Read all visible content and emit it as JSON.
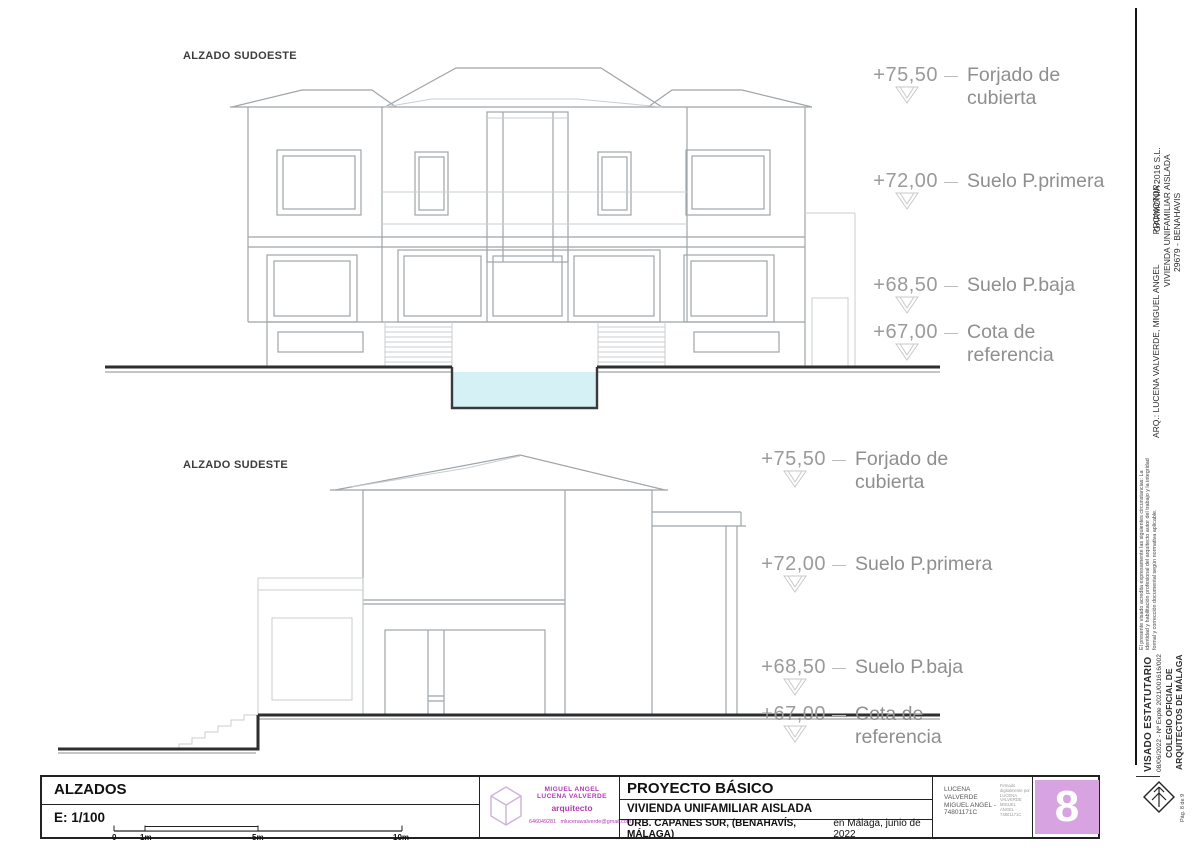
{
  "elevations": [
    {
      "label": "ALZADO SUDOESTE",
      "markers": [
        {
          "value": "+75,50",
          "label1": "Forjado de",
          "label2": "cubierta"
        },
        {
          "value": "+72,00",
          "label1": "Suelo P.primera",
          "label2": ""
        },
        {
          "value": "+68,50",
          "label1": "Suelo P.baja",
          "label2": ""
        },
        {
          "value": "+67,00",
          "label1": "Cota de",
          "label2": "referencia"
        }
      ]
    },
    {
      "label": "ALZADO SUDESTE",
      "markers": [
        {
          "value": "+75,50",
          "label1": "Forjado de",
          "label2": "cubierta"
        },
        {
          "value": "+72,00",
          "label1": "Suelo P.primera",
          "label2": ""
        },
        {
          "value": "+68,50",
          "label1": "Suelo P.baja",
          "label2": ""
        },
        {
          "value": "+67,00",
          "label1": "Cota de",
          "label2": "referencia"
        }
      ]
    }
  ],
  "titleblock": {
    "drawing_title": "ALZADOS",
    "scale_label": "E: 1/100",
    "scale_ticks": [
      "0",
      "1m",
      "5m",
      "10m"
    ],
    "architect": {
      "name": "MIGUEL ANGEL LUCENA VALVERDE",
      "role": "arquitecto",
      "phone": "646049281",
      "email": "mlucenavalverde@gmail.com"
    },
    "project": {
      "type": "PROYECTO BÁSICO",
      "name": "VIVIENDA UNIFAMILIAR AISLADA",
      "address": "URB. CAPANES SUR, (BENAHAVÍS, MÁLAGA)",
      "date": "en Málaga, junio de 2022"
    },
    "signature": {
      "name": "LUCENA VALVERDE MIGUEL ANGEL - 74801171C",
      "detail": "Firmado digitalmente por LUCENA VALVERDE MIGUEL ANGEL - 74801171C"
    },
    "sheet_number": "8"
  },
  "sidebar": {
    "arq_line": "ARQ.: LUCENA VALVERDE, MIGUEL ANGEL",
    "promotor_label": "PROMOTOR:",
    "promotor": "GARMONIA 2016 S.L.",
    "project": "VIVIENDA UNIFAMILIAR AISLADA",
    "location": "29679 - BENAHAVIS",
    "visado_note": "El presente visado acredita expresamente las siguientes circunstancias: La identidad y habilitación profesional del arquitecto autor del trabajo y la integridad formal y corrección documental según normativa aplicable.",
    "visado_title": "VISADO ESTATUTARIO",
    "visado_ref": "08/06/2022 - Nº Expte 2021/001616/002",
    "colegio_line1": "COLEGIO OFICIAL DE",
    "colegio_line2": "ARQUITECTOS DE MÁLAGA",
    "page": "Pág. 8 de 9"
  },
  "colors": {
    "pool_water": "#d6f1f6",
    "badge_purple": "#d7a3e0",
    "architect_magenta": "#b23ab2",
    "drawing_gray": "#9fa5a8",
    "marker_gray": "#9b9b9b"
  }
}
